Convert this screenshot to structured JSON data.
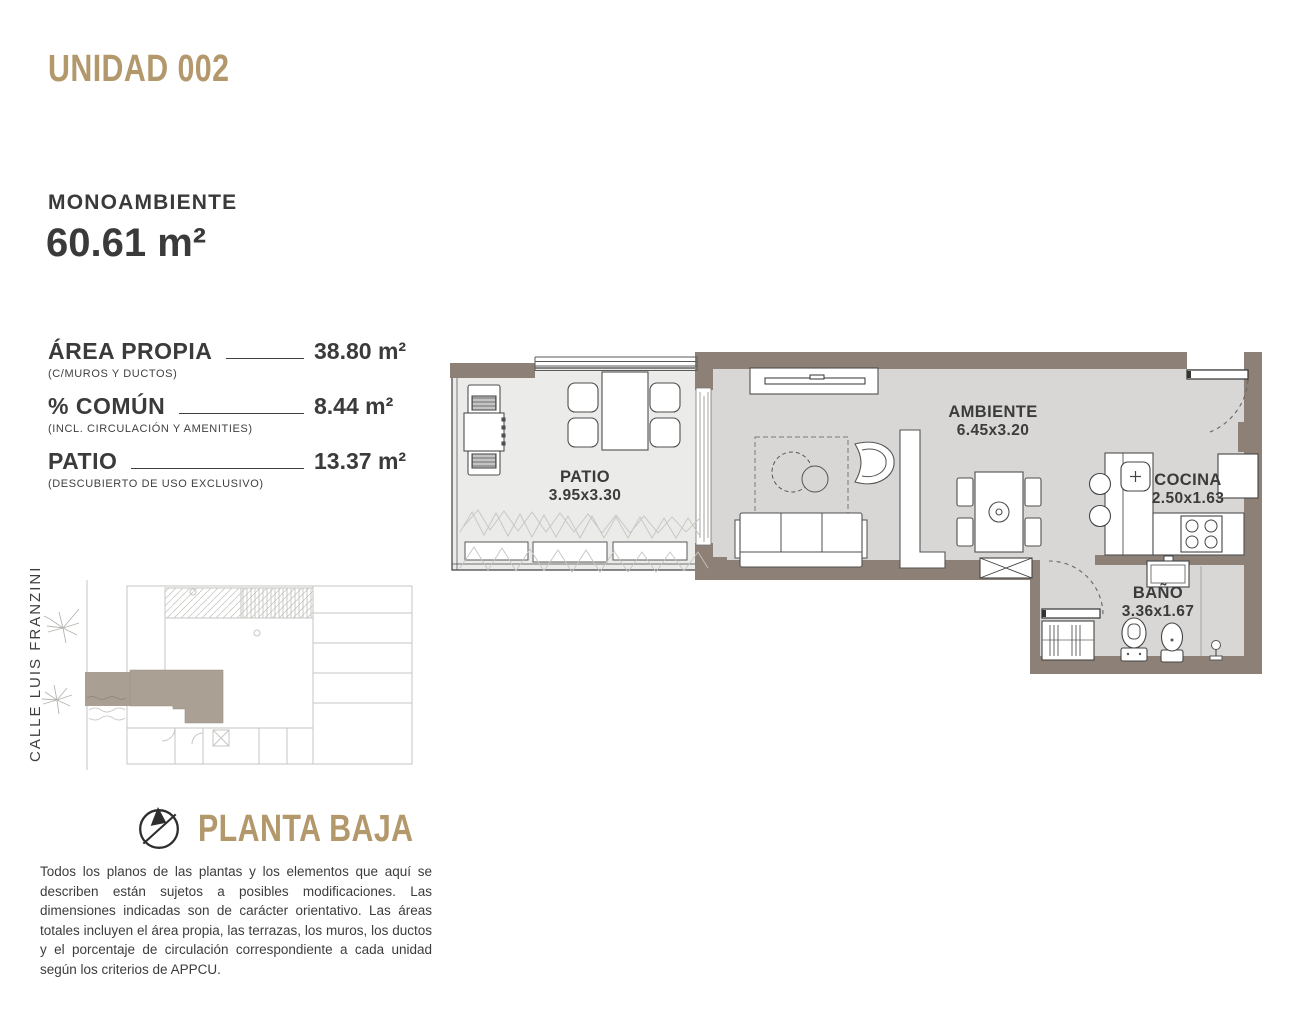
{
  "header": {
    "unit_title": "UNIDAD 002"
  },
  "summary": {
    "type_label": "MONOAMBIENTE",
    "total_area": "60.61 m²"
  },
  "areas": [
    {
      "label": "ÁREA PROPIA",
      "caption": "(C/MUROS Y DUCTOS)",
      "value": "38.80 m²"
    },
    {
      "label": "% COMÚN",
      "caption": "(INCL. CIRCULACIÓN Y AMENITIES)",
      "value": "8.44 m²"
    },
    {
      "label": "PATIO",
      "caption": "(DESCUBIERTO DE USO EXCLUSIVO)",
      "value": "13.37 m²"
    }
  ],
  "site_plan": {
    "street_label": "CALLE LUIS FRANZINI"
  },
  "floor": {
    "label": "PLANTA BAJA"
  },
  "disclaimer": "Todos los planos de las plantas y los elementos que aquí se describen están sujetos a posibles modificaciones. Las dimensiones indicadas son de carácter orientativo. Las áreas totales incluyen el área propia, las terrazas, los muros, los ductos y el porcentaje de circulación correspondiente a cada unidad según los criterios de APPCU.",
  "plan": {
    "rooms": [
      {
        "name": "PATIO",
        "dims": "3.95x3.30"
      },
      {
        "name": "AMBIENTE",
        "dims": "6.45x3.20"
      },
      {
        "name": "COCINA",
        "dims": "2.50x1.63"
      },
      {
        "name": "BAÑO",
        "dims": "3.36x1.67"
      }
    ]
  },
  "colors": {
    "accent_gold": "#b3986c",
    "wall": "#8d8177",
    "floor": "#d8d7d5",
    "patio_floor": "#ebebe9",
    "text_dark": "#3b3b3b"
  }
}
